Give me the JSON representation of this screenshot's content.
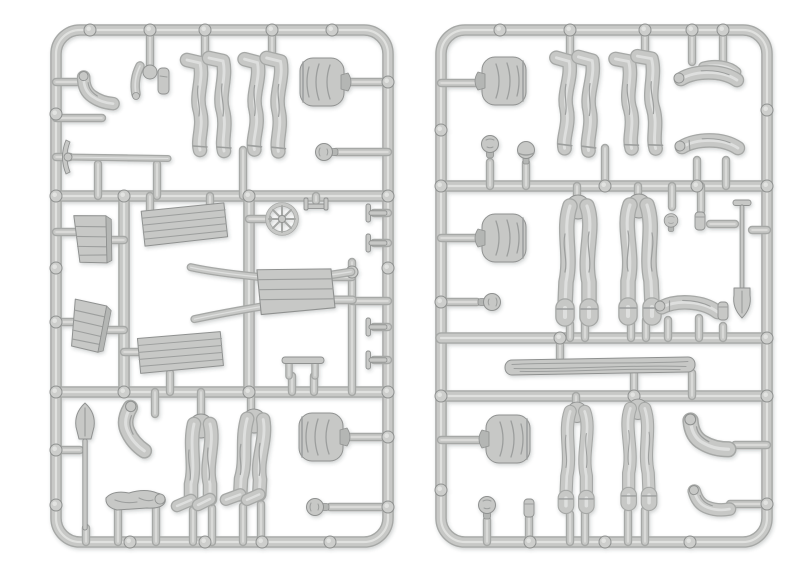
{
  "image": {
    "width": 800,
    "height": 578,
    "background": "#ffffff",
    "description": "Two light-gray plastic model-kit sprues with unpainted miniature figure parts: legs, torsos, heads, arms, shovels, a pickaxe, crates, plank stacks, a wheelbarrow, a spoked wheel and a log"
  },
  "palette": {
    "plastic_base": "#c7c8c6",
    "plastic_light": "#e4e5e3",
    "plastic_dark": "#a6a8a6",
    "plastic_edge": "#8f9190",
    "plastic_shadow": "#b4b6b4",
    "detail_line": "#9c9e9d",
    "nub_fill": "#cdcecc"
  },
  "sprues": [
    {
      "name": "left-sprue",
      "frame": {
        "x": 56,
        "y": 30,
        "w": 332,
        "h": 512,
        "r": 24
      },
      "runners": [
        [
          56,
          196,
          388,
          196
        ],
        [
          56,
          392,
          388,
          392
        ],
        [
          124,
          196,
          124,
          392
        ],
        [
          249,
          196,
          249,
          392
        ]
      ],
      "gates": [
        [
          150,
          30,
          150,
          66
        ],
        [
          205,
          30,
          205,
          58
        ],
        [
          272,
          30,
          272,
          58
        ],
        [
          56,
          82,
          80,
          82
        ],
        [
          56,
          118,
          102,
          118
        ],
        [
          345,
          82,
          388,
          82
        ],
        [
          336,
          152,
          388,
          152
        ],
        [
          56,
          157,
          70,
          157
        ],
        [
          98,
          164,
          98,
          196
        ],
        [
          157,
          164,
          157,
          196
        ],
        [
          243,
          150,
          243,
          196
        ],
        [
          150,
          196,
          150,
          213
        ],
        [
          210,
          196,
          210,
          211
        ],
        [
          249,
          219,
          268,
          219
        ],
        [
          316,
          196,
          316,
          201
        ],
        [
          374,
          213,
          388,
          213
        ],
        [
          374,
          243,
          388,
          243
        ],
        [
          374,
          327,
          388,
          327
        ],
        [
          374,
          360,
          388,
          360
        ],
        [
          56,
          232,
          78,
          232
        ],
        [
          108,
          240,
          124,
          240
        ],
        [
          56,
          322,
          76,
          322
        ],
        [
          103,
          330,
          124,
          330
        ],
        [
          124,
          352,
          142,
          352
        ],
        [
          170,
          373,
          170,
          392
        ],
        [
          352,
          262,
          352,
          392
        ],
        [
          352,
          301,
          388,
          301
        ],
        [
          332,
          277,
          352,
          277
        ],
        [
          332,
          300,
          352,
          300
        ],
        [
          292,
          376,
          292,
          392
        ],
        [
          314,
          376,
          314,
          392
        ],
        [
          56,
          450,
          80,
          450
        ],
        [
          86,
          528,
          86,
          542
        ],
        [
          155,
          392,
          155,
          414
        ],
        [
          201,
          392,
          201,
          420
        ],
        [
          251,
          392,
          251,
          414
        ],
        [
          193,
          510,
          193,
          542
        ],
        [
          212,
          508,
          212,
          542
        ],
        [
          243,
          506,
          243,
          542
        ],
        [
          261,
          504,
          261,
          542
        ],
        [
          345,
          437,
          388,
          437
        ],
        [
          330,
          507,
          388,
          507
        ],
        [
          118,
          508,
          118,
          542
        ],
        [
          156,
          508,
          156,
          542
        ]
      ],
      "nubs": [
        [
          90,
          30
        ],
        [
          150,
          30
        ],
        [
          205,
          30
        ],
        [
          272,
          30
        ],
        [
          332,
          30
        ],
        [
          56,
          114
        ],
        [
          56,
          196
        ],
        [
          56,
          268
        ],
        [
          56,
          322
        ],
        [
          56,
          392
        ],
        [
          56,
          450
        ],
        [
          56,
          505
        ],
        [
          388,
          82
        ],
        [
          388,
          196
        ],
        [
          388,
          268
        ],
        [
          388,
          392
        ],
        [
          388,
          437
        ],
        [
          388,
          507
        ],
        [
          130,
          542
        ],
        [
          205,
          542
        ],
        [
          262,
          542
        ],
        [
          330,
          542
        ],
        [
          124,
          196
        ],
        [
          249,
          196
        ],
        [
          124,
          392
        ],
        [
          249,
          392
        ],
        [
          352,
          272
        ]
      ],
      "parts": [
        {
          "t": "arm_bent",
          "n": "arm-part",
          "x": 97,
          "y": 92,
          "r": -5
        },
        {
          "t": "cluster",
          "n": "parts-cluster",
          "x": 150,
          "y": 80
        },
        {
          "t": "leg_down",
          "n": "legs-part",
          "x": 212,
          "y": 104
        },
        {
          "t": "leg_down",
          "n": "legs-part",
          "x": 268,
          "y": 104,
          "r": 2
        },
        {
          "t": "torso",
          "n": "torso-part",
          "x": 322,
          "y": 82,
          "r": 90
        },
        {
          "t": "head",
          "n": "head-part",
          "x": 326,
          "y": 152,
          "r": -90
        },
        {
          "t": "pickaxe",
          "n": "pickaxe-part",
          "x": 118,
          "y": 157
        },
        {
          "t": "crate",
          "n": "crate-part",
          "x": 93,
          "y": 240,
          "r": -5
        },
        {
          "t": "crate",
          "n": "crate-part",
          "x": 89,
          "y": 327,
          "r": 7
        },
        {
          "t": "plank",
          "n": "plank-part",
          "x": 184,
          "y": 226,
          "r": -3
        },
        {
          "t": "plank",
          "n": "plank-part",
          "x": 180,
          "y": 354,
          "r": -2
        },
        {
          "t": "wheel",
          "n": "wheel-part",
          "x": 282,
          "y": 219
        },
        {
          "t": "bracket",
          "n": "bracket-part",
          "x": 316,
          "y": 206
        },
        {
          "t": "barrow",
          "n": "wheelbarrow-part",
          "x": 272,
          "y": 290,
          "r": -3
        },
        {
          "t": "t_clamp",
          "n": "clamp-part",
          "x": 377,
          "y": 213
        },
        {
          "t": "t_clamp",
          "n": "clamp-part",
          "x": 377,
          "y": 243
        },
        {
          "t": "t_clamp",
          "n": "clamp-part",
          "x": 377,
          "y": 327
        },
        {
          "t": "t_clamp",
          "n": "clamp-part",
          "x": 377,
          "y": 360
        },
        {
          "t": "small_bar",
          "n": "bar-part",
          "x": 303,
          "y": 366
        },
        {
          "t": "shovel_up",
          "n": "shovel-part",
          "x": 85,
          "y": 466
        },
        {
          "t": "arm_bent",
          "n": "arm-part",
          "x": 135,
          "y": 430,
          "r": 25,
          "sx": 1.15,
          "sy": 1.15
        },
        {
          "t": "leg_up",
          "n": "legs-part",
          "x": 201,
          "y": 466
        },
        {
          "t": "leg_up",
          "n": "legs-part",
          "x": 252,
          "y": 461,
          "r": 3
        },
        {
          "t": "torso",
          "n": "torso-part",
          "x": 321,
          "y": 437,
          "r": 90
        },
        {
          "t": "head",
          "n": "head-part",
          "x": 317,
          "y": 507,
          "r": -90
        },
        {
          "t": "body_lying",
          "n": "lying-figure-part",
          "x": 137,
          "y": 502
        }
      ]
    },
    {
      "name": "right-sprue",
      "frame": {
        "x": 441,
        "y": 30,
        "w": 326,
        "h": 512,
        "r": 24
      },
      "runners": [
        [
          441,
          186,
          767,
          186
        ],
        [
          441,
          338,
          767,
          338
        ],
        [
          441,
          396,
          767,
          396
        ]
      ],
      "gates": [
        [
          570,
          30,
          570,
          58
        ],
        [
          645,
          30,
          645,
          56
        ],
        [
          692,
          30,
          692,
          62
        ],
        [
          723,
          30,
          723,
          62
        ],
        [
          441,
          83,
          478,
          83
        ],
        [
          490,
          162,
          490,
          186
        ],
        [
          526,
          163,
          526,
          186
        ],
        [
          605,
          148,
          605,
          186
        ],
        [
          697,
          160,
          697,
          186
        ],
        [
          726,
          160,
          726,
          186
        ],
        [
          441,
          238,
          480,
          238
        ],
        [
          577,
          186,
          577,
          202
        ],
        [
          638,
          186,
          638,
          200
        ],
        [
          570,
          324,
          570,
          338
        ],
        [
          585,
          322,
          585,
          338
        ],
        [
          631,
          320,
          631,
          338
        ],
        [
          646,
          320,
          646,
          338
        ],
        [
          672,
          186,
          672,
          207
        ],
        [
          701,
          186,
          701,
          211
        ],
        [
          710,
          224,
          735,
          224
        ],
        [
          752,
          230,
          767,
          230
        ],
        [
          441,
          302,
          477,
          302
        ],
        [
          668,
          320,
          668,
          338
        ],
        [
          699,
          318,
          699,
          338
        ],
        [
          723,
          326,
          723,
          338
        ],
        [
          560,
          338,
          560,
          358
        ],
        [
          634,
          373,
          634,
          396
        ],
        [
          692,
          373,
          692,
          396
        ],
        [
          441,
          440,
          487,
          440
        ],
        [
          576,
          396,
          576,
          412
        ],
        [
          636,
          396,
          636,
          410
        ],
        [
          570,
          514,
          570,
          542
        ],
        [
          585,
          512,
          585,
          542
        ],
        [
          628,
          512,
          628,
          542
        ],
        [
          645,
          510,
          645,
          542
        ],
        [
          735,
          445,
          767,
          445
        ],
        [
          730,
          504,
          767,
          504
        ],
        [
          487,
          520,
          487,
          542
        ],
        [
          529,
          518,
          529,
          542
        ]
      ],
      "nubs": [
        [
          500,
          30
        ],
        [
          570,
          30
        ],
        [
          645,
          30
        ],
        [
          692,
          30
        ],
        [
          723,
          30
        ],
        [
          441,
          130
        ],
        [
          441,
          186
        ],
        [
          441,
          302
        ],
        [
          441,
          396
        ],
        [
          441,
          490
        ],
        [
          767,
          110
        ],
        [
          767,
          186
        ],
        [
          767,
          338
        ],
        [
          767,
          396
        ],
        [
          767,
          504
        ],
        [
          530,
          542
        ],
        [
          605,
          542
        ],
        [
          690,
          542
        ],
        [
          605,
          186
        ],
        [
          697,
          186
        ],
        [
          560,
          338
        ],
        [
          634,
          396
        ]
      ],
      "parts": [
        {
          "t": "torso",
          "n": "torso-part",
          "x": 504,
          "y": 81,
          "r": -90
        },
        {
          "t": "leg_down",
          "n": "legs-part",
          "x": 579,
          "y": 103,
          "r": 3
        },
        {
          "t": "leg_down",
          "n": "legs-part",
          "x": 642,
          "y": 102,
          "r": -2
        },
        {
          "t": "arm_pair",
          "n": "arms-part",
          "x": 707,
          "y": 77,
          "r": 2
        },
        {
          "t": "arm_straight",
          "n": "arm-part",
          "x": 708,
          "y": 145,
          "r": 2
        },
        {
          "t": "head",
          "n": "head-part",
          "x": 490,
          "y": 146
        },
        {
          "t": "helmet",
          "n": "helmet-head-part",
          "x": 526,
          "y": 151
        },
        {
          "t": "torso",
          "n": "torso-part",
          "x": 504,
          "y": 238,
          "r": -90
        },
        {
          "t": "leg_cuff",
          "n": "legs-part",
          "x": 578,
          "y": 262
        },
        {
          "t": "leg_cuff",
          "n": "legs-part",
          "x": 639,
          "y": 261,
          "sx": -1
        },
        {
          "t": "head",
          "n": "head-part",
          "x": 671,
          "y": 222,
          "sx": 0.8,
          "sy": 0.8
        },
        {
          "t": "cyl_small",
          "n": "canteen-part",
          "x": 700,
          "y": 221
        },
        {
          "t": "spade_T",
          "n": "spade-part",
          "x": 742,
          "y": 258
        },
        {
          "t": "head",
          "n": "head-part",
          "x": 490,
          "y": 302,
          "r": 90
        },
        {
          "t": "arm_straight",
          "n": "arm-part",
          "x": 688,
          "y": 307,
          "r": 6
        },
        {
          "t": "cyl_small",
          "n": "canteen-part",
          "x": 723,
          "y": 311
        },
        {
          "t": "log",
          "n": "log-part",
          "x": 600,
          "y": 366,
          "r": -1
        },
        {
          "t": "torso",
          "n": "torso-part",
          "x": 508,
          "y": 439,
          "r": -90
        },
        {
          "t": "leg_cuff",
          "n": "legs-part",
          "x": 577,
          "y": 459,
          "sx": 0.85,
          "sy": 0.85
        },
        {
          "t": "leg_cuff",
          "n": "legs-part",
          "x": 638,
          "y": 456,
          "sx": -0.85,
          "sy": 0.85
        },
        {
          "t": "arm_bent",
          "n": "arm-part",
          "x": 708,
          "y": 437,
          "r": -10,
          "sx": 1.2,
          "sy": 1.2
        },
        {
          "t": "arm_bent",
          "n": "arm-part",
          "x": 711,
          "y": 502,
          "r": -20
        },
        {
          "t": "head",
          "n": "head-part",
          "x": 487,
          "y": 507
        },
        {
          "t": "cyl_small",
          "n": "cap-part",
          "x": 529,
          "y": 508
        }
      ]
    }
  ]
}
